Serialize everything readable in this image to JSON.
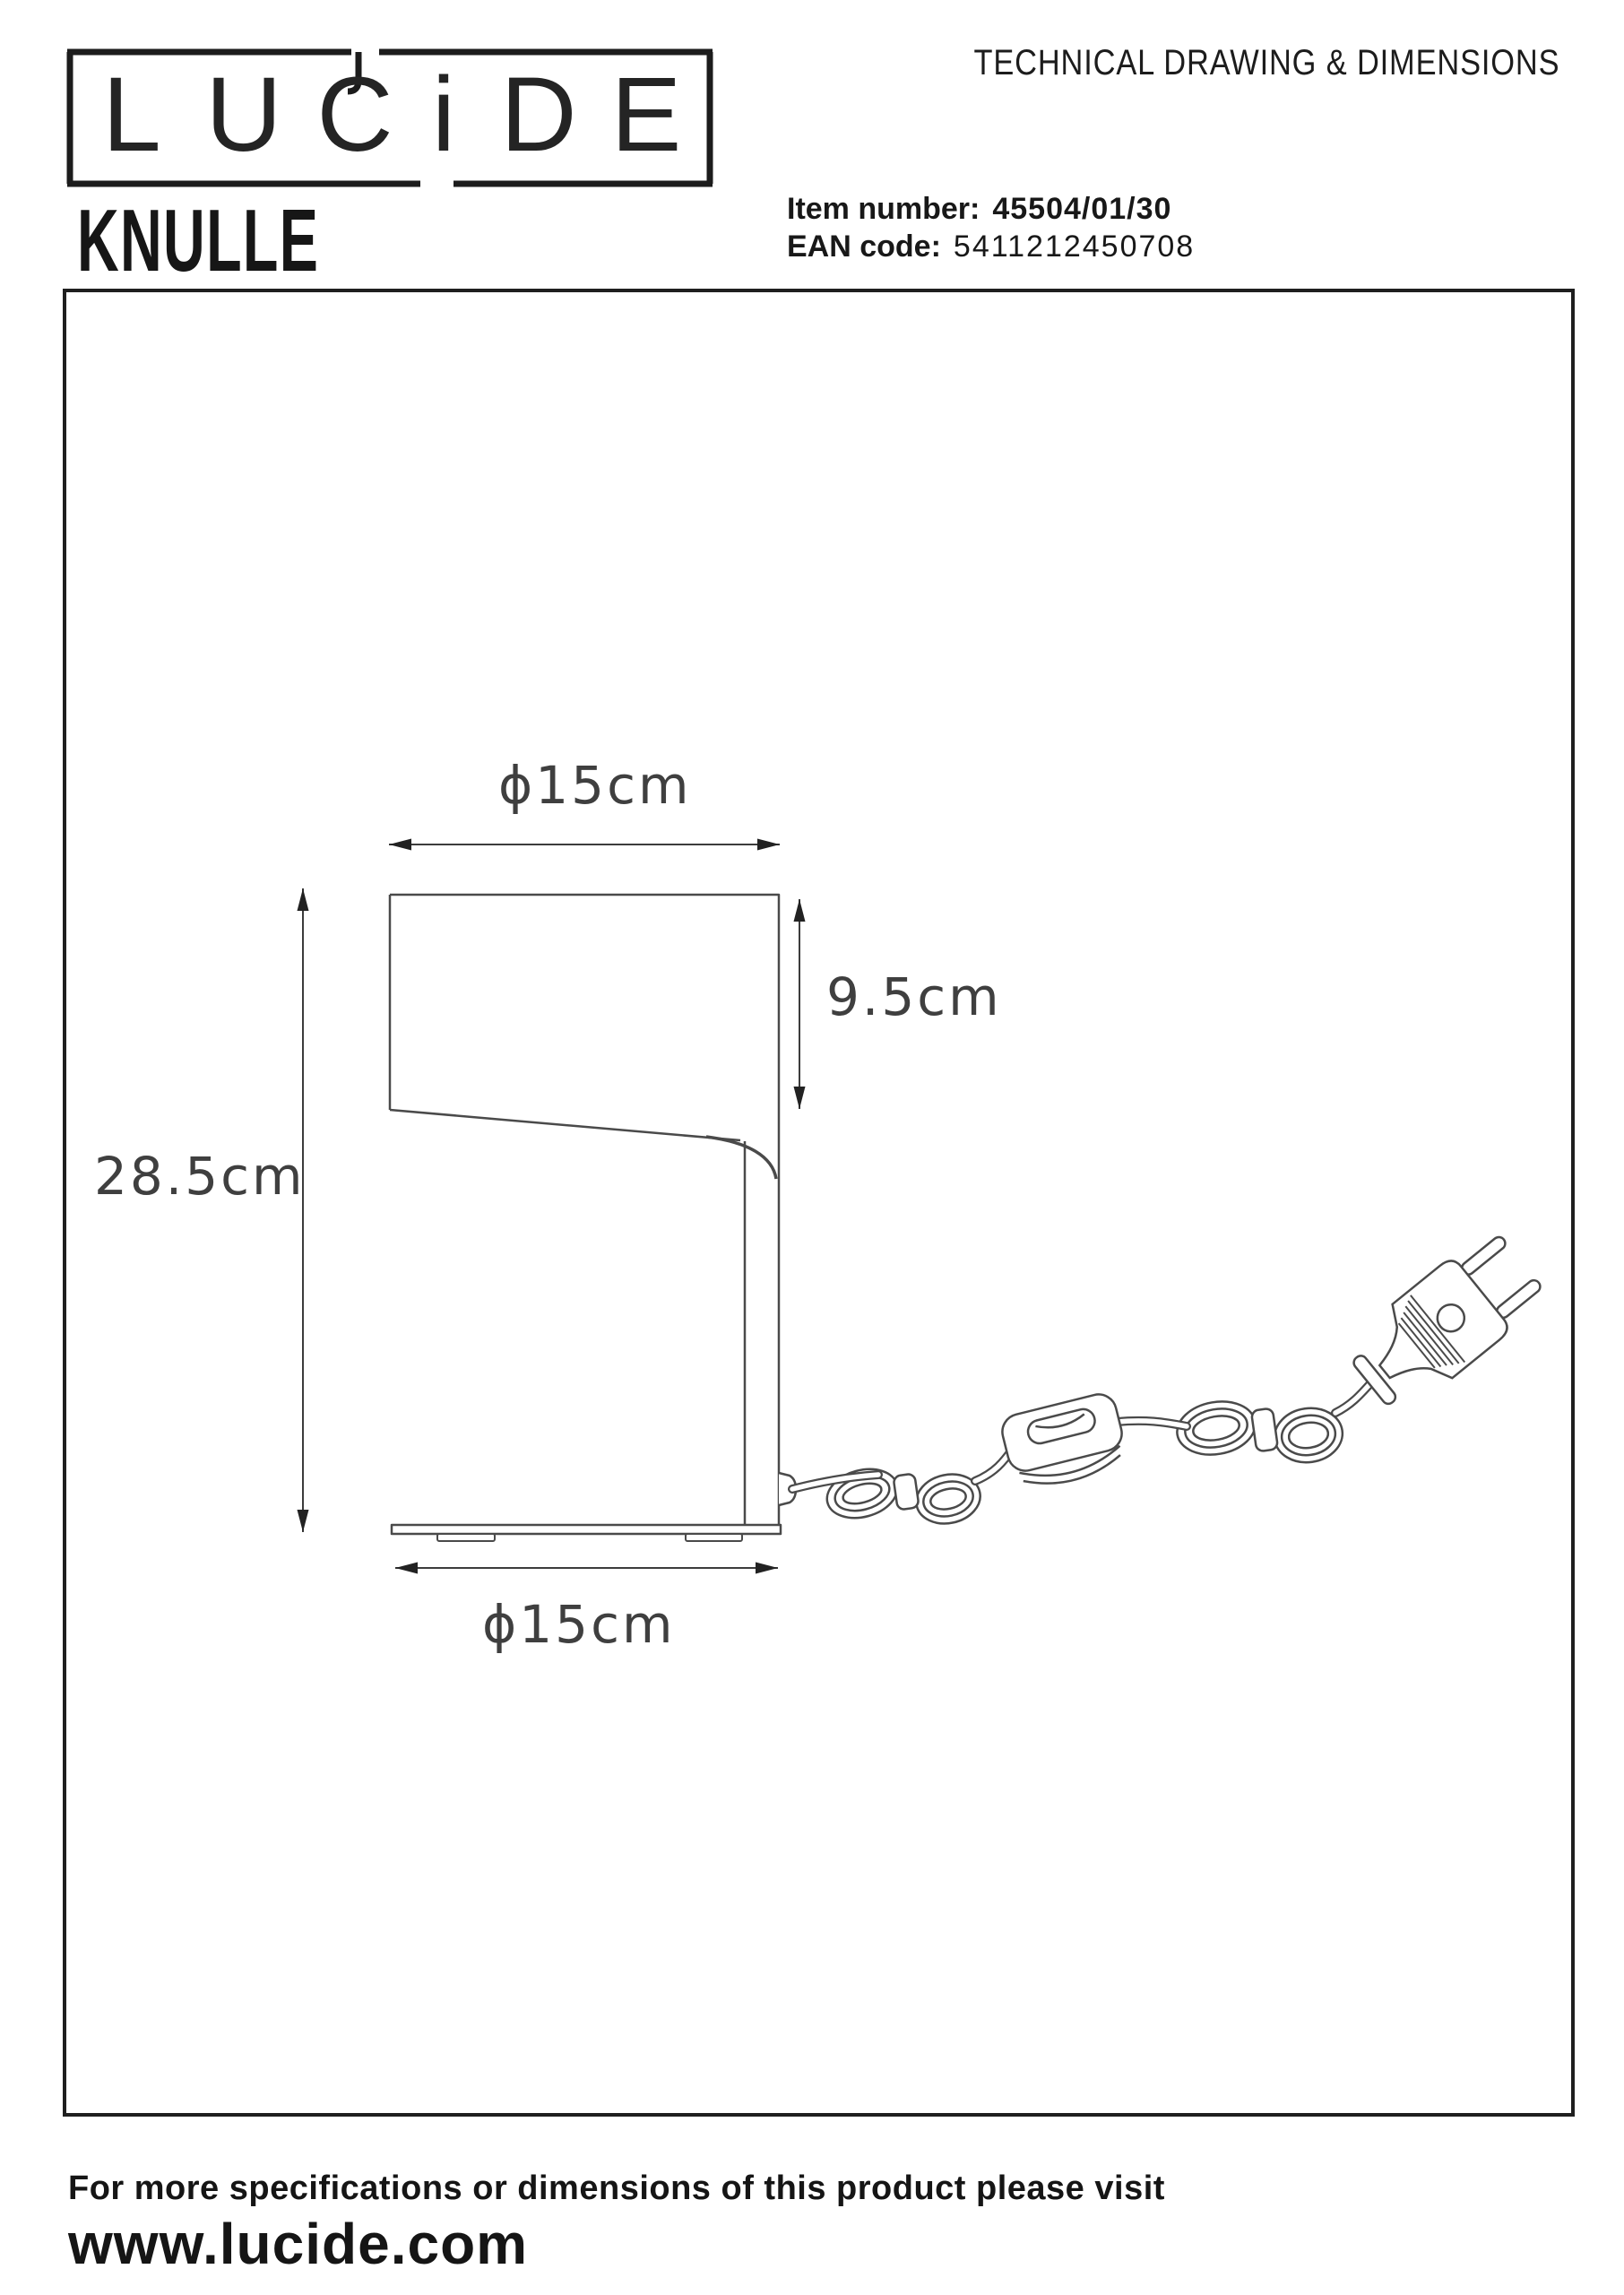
{
  "header": {
    "logo": {
      "letters": [
        "L",
        "U",
        "C",
        "i",
        "D",
        "E"
      ]
    },
    "doc_title": "TECHNICAL DRAWING & DIMENSIONS",
    "product_name": "KNULLE",
    "item_number_label": "Item number:",
    "item_number_value": "45504/01/30",
    "ean_label": "EAN code:",
    "ean_value": "5411212450708"
  },
  "drawing": {
    "dim_top_width": "ɸ15cm",
    "dim_shade_height": "9.5cm",
    "dim_total_height": "28.5cm",
    "dim_base_width": "ɸ15cm"
  },
  "footer": {
    "note": "For more specifications or dimensions of this product please visit",
    "website": "www.lucide.com"
  },
  "colors": {
    "ink": "#111111",
    "drawing_line": "#4a4a4a",
    "dimension_text": "#3f3f3f",
    "frame_border": "#1f1f1f",
    "background": "#ffffff"
  }
}
